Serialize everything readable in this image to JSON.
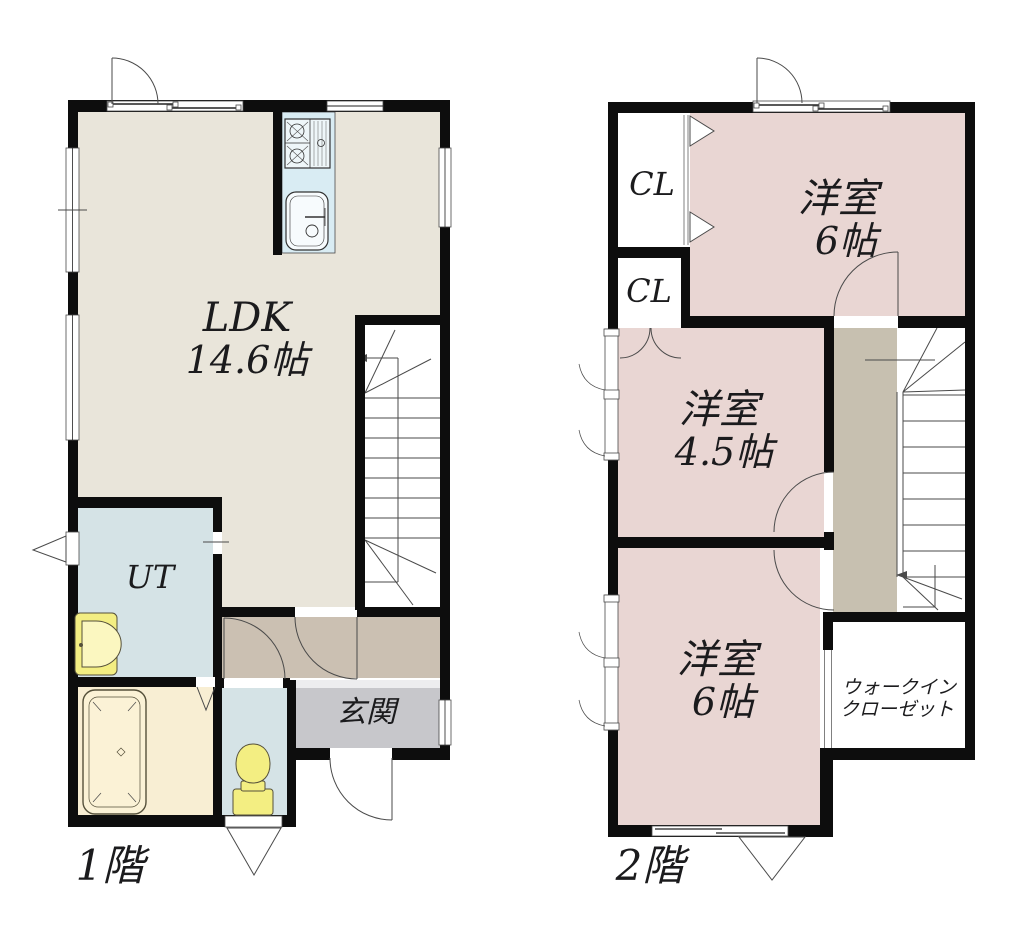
{
  "colors": {
    "wall": "#0d0d0d",
    "line": "#4a4a4a",
    "ldk": "#e9e5da",
    "bedroom": "#e9d6d3",
    "wet": "#d5e3e6",
    "bath": "#f8eed3",
    "kitchen": "#d9ecf3",
    "hallway1": "#cbc0b2",
    "hallway2": "#c7c0b0",
    "entrance": "#c7c7cb",
    "fixture": "#f3ee82"
  },
  "floor1": {
    "label": "1階",
    "ldk": {
      "name": "LDK",
      "size": "14.6帖"
    },
    "utility": {
      "label": "UT"
    },
    "entrance": {
      "label": "玄関"
    }
  },
  "floor2": {
    "label": "2階",
    "closet_upper": {
      "label": "CL"
    },
    "closet_lower": {
      "label": "CL"
    },
    "bedroom_north": {
      "name": "洋室",
      "size": "6帖"
    },
    "bedroom_middle": {
      "name": "洋室",
      "size": "4.5帖"
    },
    "bedroom_south": {
      "name": "洋室",
      "size": "6帖"
    },
    "walk_in_closet": {
      "line1": "ウォークイン",
      "line2": "クローゼット"
    }
  }
}
